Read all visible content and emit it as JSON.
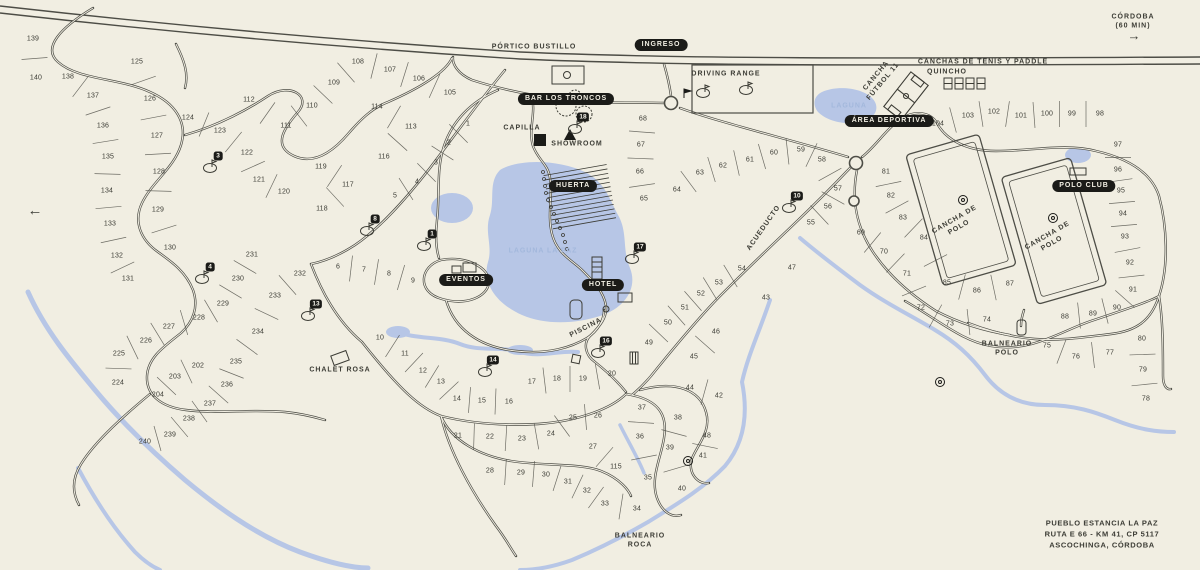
{
  "title": "Pueblo Estancia La Paz - plano",
  "address": {
    "line1": "PUEBLO ESTANCIA LA PAZ",
    "line2": "RUTA E 66 - KM 41, CP 5117",
    "line3": "ASCOCHINGA, CÓRDOBA"
  },
  "colors": {
    "background": "#f1eee2",
    "ink": "#3c3c35",
    "road": "#4d4d46",
    "water": "#b7c6e6",
    "water_label": "#a3b8dc",
    "badge_bg": "#1b1b18",
    "badge_text": "#f2efe3"
  },
  "amenity_badges": [
    {
      "label": "INGRESO",
      "x": 661,
      "y": 45
    },
    {
      "label": "BAR LOS TRONCOS",
      "x": 566,
      "y": 99
    },
    {
      "label": "HUERTA",
      "x": 573,
      "y": 186
    },
    {
      "label": "EVENTOS",
      "x": 466,
      "y": 280
    },
    {
      "label": "HOTEL",
      "x": 603,
      "y": 285
    },
    {
      "label": "ÁREA DEPORTIVA",
      "x": 889,
      "y": 121
    },
    {
      "label": "POLO CLUB",
      "x": 1084,
      "y": 186
    }
  ],
  "map_labels": [
    {
      "text": "PÓRTICO BUSTILLO",
      "x": 534,
      "y": 47
    },
    {
      "text": "CAPILLA",
      "x": 522,
      "y": 128
    },
    {
      "text": "SHOWROOM",
      "x": 577,
      "y": 144
    },
    {
      "text": "DRIVING RANGE",
      "x": 726,
      "y": 74
    },
    {
      "text": "CANCHAS DE TENIS Y PADDLE",
      "x": 983,
      "y": 62
    },
    {
      "text": "QUINCHO",
      "x": 947,
      "y": 72
    },
    {
      "text": "CANCHA\nFÚTBOL 11",
      "x": 880,
      "y": 79,
      "rot": -50
    },
    {
      "text": "LAGUNA",
      "x": 849,
      "y": 106,
      "color": "#a3b8dc"
    },
    {
      "text": "LAGUNA LA PAZ",
      "x": 543,
      "y": 251,
      "color": "#a3b8dc"
    },
    {
      "text": "PISCINA",
      "x": 586,
      "y": 328,
      "rot": -27
    },
    {
      "text": "ACUEDUCTO",
      "x": 764,
      "y": 228,
      "rot": -55
    },
    {
      "text": "CHALET ROSA",
      "x": 340,
      "y": 370
    },
    {
      "text": "BALNEARIO\nPOLO",
      "x": 1007,
      "y": 349
    },
    {
      "text": "BALNEARIO\nROCA",
      "x": 640,
      "y": 541
    },
    {
      "text": "CANCHA DE\nPOLO",
      "x": 957,
      "y": 224,
      "rot": -30
    },
    {
      "text": "CANCHA DE\nPOLO",
      "x": 1050,
      "y": 240,
      "rot": -30
    },
    {
      "text": "CÓRDOBA\n(60 MIN)",
      "x": 1133,
      "y": 22
    },
    {
      "text": "→",
      "x": 1134,
      "y": 36,
      "size": 13,
      "spacing": "0"
    },
    {
      "text": "←",
      "x": 35,
      "y": 211,
      "size": 15,
      "spacing": "0"
    }
  ],
  "golf_holes": [
    {
      "hole": "1",
      "x": 432,
      "y": 234
    },
    {
      "hole": "3",
      "x": 218,
      "y": 156
    },
    {
      "hole": "4",
      "x": 210,
      "y": 267
    },
    {
      "hole": "8",
      "x": 375,
      "y": 219
    },
    {
      "hole": "10",
      "x": 797,
      "y": 196
    },
    {
      "hole": "13",
      "x": 316,
      "y": 304
    },
    {
      "hole": "14",
      "x": 493,
      "y": 360
    },
    {
      "hole": "16",
      "x": 606,
      "y": 341
    },
    {
      "hole": "17",
      "x": 640,
      "y": 247
    },
    {
      "hole": "18",
      "x": 583,
      "y": 117
    }
  ],
  "map_pois": [
    {
      "type": "flag",
      "x": 684,
      "y": 98
    },
    {
      "type": "green",
      "x": 703,
      "y": 93
    },
    {
      "type": "green",
      "x": 746,
      "y": 90
    },
    {
      "type": "circle",
      "x": 940,
      "y": 382
    },
    {
      "type": "circle",
      "x": 688,
      "y": 461
    },
    {
      "type": "circle",
      "x": 963,
      "y": 200
    },
    {
      "type": "circle",
      "x": 1053,
      "y": 218
    }
  ],
  "lots": [
    [
      "139",
      33,
      39
    ],
    [
      "140",
      36,
      78
    ],
    [
      "138",
      68,
      77
    ],
    [
      "137",
      93,
      96
    ],
    [
      "136",
      103,
      126
    ],
    [
      "135",
      108,
      157
    ],
    [
      "134",
      107,
      191
    ],
    [
      "133",
      110,
      224
    ],
    [
      "132",
      117,
      256
    ],
    [
      "131",
      128,
      279
    ],
    [
      "125",
      137,
      62
    ],
    [
      "126",
      150,
      99
    ],
    [
      "127",
      157,
      136
    ],
    [
      "128",
      159,
      172
    ],
    [
      "129",
      158,
      210
    ],
    [
      "130",
      170,
      248
    ],
    [
      "124",
      188,
      118
    ],
    [
      "123",
      220,
      131
    ],
    [
      "122",
      247,
      153
    ],
    [
      "121",
      259,
      180
    ],
    [
      "120",
      284,
      192
    ],
    [
      "112",
      249,
      100
    ],
    [
      "111",
      286,
      126
    ],
    [
      "110",
      312,
      106
    ],
    [
      "109",
      334,
      83
    ],
    [
      "108",
      358,
      62
    ],
    [
      "107",
      390,
      70
    ],
    [
      "106",
      419,
      79
    ],
    [
      "105",
      450,
      93
    ],
    [
      "114",
      377,
      107
    ],
    [
      "113",
      411,
      127
    ],
    [
      "116",
      384,
      157
    ],
    [
      "119",
      321,
      167
    ],
    [
      "117",
      348,
      185
    ],
    [
      "118",
      322,
      209
    ],
    [
      "115",
      616,
      467
    ],
    [
      "1",
      468,
      124
    ],
    [
      "2",
      449,
      143
    ],
    [
      "3",
      436,
      163
    ],
    [
      "4",
      417,
      182
    ],
    [
      "5",
      395,
      196
    ],
    [
      "6",
      338,
      267
    ],
    [
      "7",
      364,
      270
    ],
    [
      "8",
      389,
      274
    ],
    [
      "9",
      413,
      281
    ],
    [
      "10",
      380,
      338
    ],
    [
      "11",
      405,
      354
    ],
    [
      "12",
      423,
      371
    ],
    [
      "13",
      441,
      382
    ],
    [
      "14",
      457,
      399
    ],
    [
      "15",
      482,
      401
    ],
    [
      "16",
      509,
      402
    ],
    [
      "17",
      532,
      382
    ],
    [
      "18",
      557,
      379
    ],
    [
      "19",
      583,
      379
    ],
    [
      "20",
      612,
      374
    ],
    [
      "21",
      458,
      436
    ],
    [
      "22",
      490,
      437
    ],
    [
      "23",
      522,
      439
    ],
    [
      "24",
      551,
      434
    ],
    [
      "25",
      573,
      418
    ],
    [
      "26",
      598,
      416
    ],
    [
      "27",
      593,
      447
    ],
    [
      "28",
      490,
      471
    ],
    [
      "29",
      521,
      473
    ],
    [
      "30",
      546,
      475
    ],
    [
      "31",
      568,
      482
    ],
    [
      "32",
      587,
      491
    ],
    [
      "33",
      605,
      504
    ],
    [
      "34",
      637,
      509
    ],
    [
      "35",
      648,
      478
    ],
    [
      "36",
      640,
      437
    ],
    [
      "37",
      642,
      408
    ],
    [
      "38",
      678,
      418
    ],
    [
      "39",
      670,
      448
    ],
    [
      "40",
      682,
      489
    ],
    [
      "41",
      703,
      456
    ],
    [
      "42",
      719,
      396
    ],
    [
      "43",
      766,
      298
    ],
    [
      "44",
      690,
      388
    ],
    [
      "45",
      694,
      357
    ],
    [
      "46",
      716,
      332
    ],
    [
      "47",
      792,
      268
    ],
    [
      "48",
      707,
      436
    ],
    [
      "49",
      649,
      343
    ],
    [
      "50",
      668,
      323
    ],
    [
      "51",
      685,
      308
    ],
    [
      "52",
      701,
      294
    ],
    [
      "53",
      719,
      283
    ],
    [
      "54",
      742,
      269
    ],
    [
      "55",
      811,
      223
    ],
    [
      "56",
      828,
      207
    ],
    [
      "57",
      838,
      189
    ],
    [
      "58",
      822,
      160
    ],
    [
      "59",
      801,
      150
    ],
    [
      "60",
      774,
      153
    ],
    [
      "61",
      750,
      160
    ],
    [
      "62",
      723,
      166
    ],
    [
      "63",
      700,
      173
    ],
    [
      "64",
      677,
      190
    ],
    [
      "65",
      644,
      199
    ],
    [
      "66",
      640,
      172
    ],
    [
      "67",
      641,
      145
    ],
    [
      "68",
      643,
      119
    ],
    [
      "69",
      861,
      233
    ],
    [
      "70",
      884,
      252
    ],
    [
      "71",
      907,
      274
    ],
    [
      "72",
      921,
      308
    ],
    [
      "73",
      950,
      324
    ],
    [
      "74",
      987,
      320
    ],
    [
      "75",
      1047,
      346
    ],
    [
      "76",
      1076,
      357
    ],
    [
      "77",
      1110,
      353
    ],
    [
      "78",
      1146,
      399
    ],
    [
      "79",
      1143,
      370
    ],
    [
      "80",
      1142,
      339
    ],
    [
      "81",
      886,
      172
    ],
    [
      "82",
      891,
      196
    ],
    [
      "83",
      903,
      218
    ],
    [
      "84",
      924,
      238
    ],
    [
      "85",
      947,
      283
    ],
    [
      "86",
      977,
      291
    ],
    [
      "87",
      1010,
      284
    ],
    [
      "88",
      1065,
      317
    ],
    [
      "89",
      1093,
      314
    ],
    [
      "90",
      1117,
      308
    ],
    [
      "91",
      1133,
      290
    ],
    [
      "92",
      1130,
      263
    ],
    [
      "93",
      1125,
      237
    ],
    [
      "94",
      1123,
      214
    ],
    [
      "95",
      1121,
      191
    ],
    [
      "96",
      1118,
      170
    ],
    [
      "97",
      1118,
      145
    ],
    [
      "98",
      1100,
      114
    ],
    [
      "99",
      1072,
      114
    ],
    [
      "100",
      1047,
      114
    ],
    [
      "101",
      1021,
      116
    ],
    [
      "102",
      994,
      112
    ],
    [
      "103",
      968,
      116
    ],
    [
      "104",
      938,
      124
    ],
    [
      "202",
      198,
      366
    ],
    [
      "203",
      175,
      377
    ],
    [
      "204",
      158,
      395
    ],
    [
      "224",
      118,
      383
    ],
    [
      "225",
      119,
      354
    ],
    [
      "226",
      146,
      341
    ],
    [
      "227",
      169,
      327
    ],
    [
      "228",
      199,
      318
    ],
    [
      "229",
      223,
      304
    ],
    [
      "230",
      238,
      279
    ],
    [
      "231",
      252,
      255
    ],
    [
      "232",
      300,
      274
    ],
    [
      "233",
      275,
      296
    ],
    [
      "234",
      258,
      332
    ],
    [
      "235",
      236,
      362
    ],
    [
      "236",
      227,
      385
    ],
    [
      "237",
      210,
      404
    ],
    [
      "238",
      189,
      419
    ],
    [
      "239",
      170,
      435
    ],
    [
      "240",
      145,
      442
    ]
  ],
  "lot_rows": [
    [
      "139",
      "140"
    ],
    [
      "138",
      "137",
      "136",
      "135",
      "134",
      "133",
      "132",
      "131"
    ],
    [
      "125",
      "126",
      "127",
      "128",
      "129",
      "130"
    ],
    [
      "124",
      "123",
      "122",
      "121",
      "120"
    ],
    [
      "112",
      "111",
      "110",
      "109",
      "108",
      "107",
      "106",
      "105"
    ],
    [
      "114",
      "113",
      "116"
    ],
    [
      "119",
      "117",
      "118"
    ],
    [
      "1",
      "2",
      "3",
      "4",
      "5"
    ],
    [
      "68",
      "67",
      "66",
      "65"
    ],
    [
      "64",
      "63",
      "62",
      "61",
      "60",
      "59",
      "58",
      "57",
      "56",
      "55"
    ],
    [
      "6",
      "7",
      "8",
      "9"
    ],
    [
      "231",
      "230",
      "229",
      "228",
      "227",
      "226",
      "225",
      "224"
    ],
    [
      "232",
      "233",
      "234",
      "235",
      "236",
      "237",
      "238",
      "239",
      "240"
    ],
    [
      "202",
      "203",
      "204"
    ],
    [
      "10",
      "11",
      "12",
      "13",
      "14",
      "15",
      "16"
    ],
    [
      "17",
      "18",
      "19",
      "20"
    ],
    [
      "21",
      "22",
      "23",
      "24",
      "25",
      "26"
    ],
    [
      "28",
      "29",
      "30",
      "31",
      "32",
      "33",
      "34"
    ],
    [
      "37",
      "36",
      "35"
    ],
    [
      "38",
      "39",
      "40"
    ],
    [
      "44",
      "42"
    ],
    [
      "48",
      "41"
    ],
    [
      "49",
      "50",
      "51",
      "52",
      "53",
      "54"
    ],
    [
      "46",
      "45"
    ],
    [
      "69",
      "70",
      "71",
      "72",
      "73",
      "74"
    ],
    [
      "75",
      "76",
      "77"
    ],
    [
      "80",
      "79",
      "78"
    ],
    [
      "81",
      "82",
      "83",
      "84",
      "85",
      "86",
      "87"
    ],
    [
      "88",
      "89",
      "90",
      "91",
      "92",
      "93",
      "94",
      "95",
      "96",
      "97"
    ],
    [
      "104",
      "103",
      "102",
      "101",
      "100",
      "99",
      "98"
    ],
    [
      "27",
      "115"
    ]
  ]
}
